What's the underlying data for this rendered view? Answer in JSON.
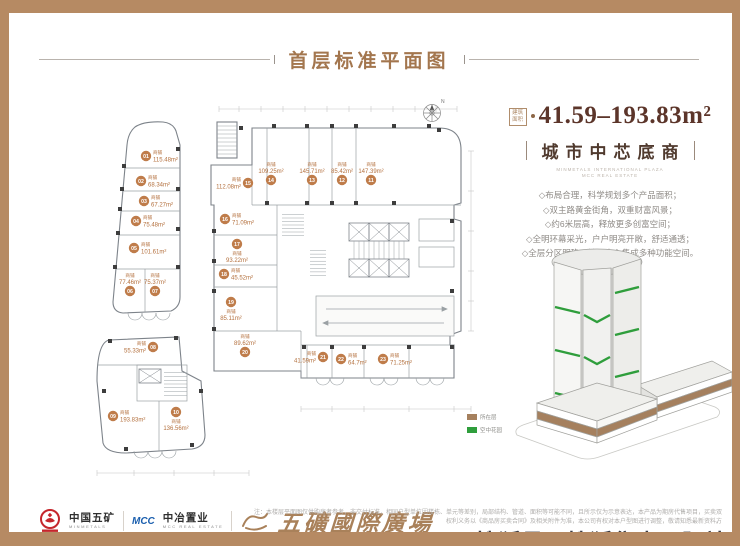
{
  "title": "首层标准平面图",
  "colors": {
    "frame_border": "#b68a63",
    "title_text": "#a3764e",
    "unit_badge": "#bf7c4a",
    "unit_text": "#b4713f",
    "area_number": "#5c352a",
    "headline_text": "#503a2e",
    "garden_green": "#2f9e3c",
    "podium_brown": "#a5805e",
    "brand_gold": "#a9815a",
    "watermark_text": "#3d3d44"
  },
  "plan": {
    "shop_label": "商铺",
    "compass": "N",
    "shops": [
      {
        "no": "01",
        "area": "115.48m²"
      },
      {
        "no": "02",
        "area": "68.34m²"
      },
      {
        "no": "03",
        "area": "67.27m²"
      },
      {
        "no": "04",
        "area": "75.48m²"
      },
      {
        "no": "05",
        "area": "101.61m²"
      },
      {
        "no": "06",
        "area": "77.46m²"
      },
      {
        "no": "07",
        "area": "75.37m²"
      },
      {
        "no": "08",
        "area": "55.33m²"
      },
      {
        "no": "09",
        "area": "193.83m²"
      },
      {
        "no": "10",
        "area": "136.56m²"
      },
      {
        "no": "11",
        "area": "147.39m²"
      },
      {
        "no": "12",
        "area": "85.42m²"
      },
      {
        "no": "13",
        "area": "145.71m²"
      },
      {
        "no": "14",
        "area": "109.25m²"
      },
      {
        "no": "15",
        "area": "112.08m²"
      },
      {
        "no": "16",
        "area": "71.09m²"
      },
      {
        "no": "17",
        "area": "93.22m²"
      },
      {
        "no": "18",
        "area": "45.52m²"
      },
      {
        "no": "19",
        "area": "85.11m²"
      },
      {
        "no": "20",
        "area": "89.62m²"
      },
      {
        "no": "21",
        "area": "41.59m²"
      },
      {
        "no": "22",
        "area": "64.7m²"
      },
      {
        "no": "23",
        "area": "71.25m²"
      }
    ]
  },
  "info_panel": {
    "area_badge": "建筑面积",
    "area_range": "41.59–193.83m²",
    "headline": "城市中芯底商",
    "subtitle_en_1": "MINMETALS INTERNATIONAL PLAZA",
    "subtitle_en_2": "MCC REAL ESTATE",
    "features": [
      "◇布局合理，科学规划多个产品面积；",
      "◇双主路黄金街角，双重财富风景；",
      "◇约6米层高，释放更多创富空间；",
      "◇全明环幕采光，户户明亮开敞，舒适通透；",
      "◇全层分区明确，楼层中心集成多种功能空间。"
    ],
    "legend": [
      {
        "label": "所在层",
        "color": "#a5805e"
      },
      {
        "label": "空中花园",
        "color": "#2f9e3c"
      }
    ]
  },
  "footer": {
    "minmetals_cn": "中国五矿",
    "minmetals_en": "MINMETALS",
    "mcc_logo": "MCC",
    "mcc_cn": "中冶置业",
    "mcc_en": "MCC REAL ESTATE",
    "brand_calligraphy": "五礦國際廣場",
    "disclaimer_1": "注：本楼层平面图仅供购房者参考，非交付标准，相同户型单位因楼栋、单元等差别，局部结构、管道、面积等可能不同，且所示仅为示意表达，本产品为期房代售项目，买卖双方",
    "disclaimer_2": "权利义务以《商品房买卖合同》及相关附件为准，本公司有权对本户型图进行调整，敬请知悉最新资料。",
    "watermark": "搜狐号@搜狐焦点邵阳站"
  }
}
